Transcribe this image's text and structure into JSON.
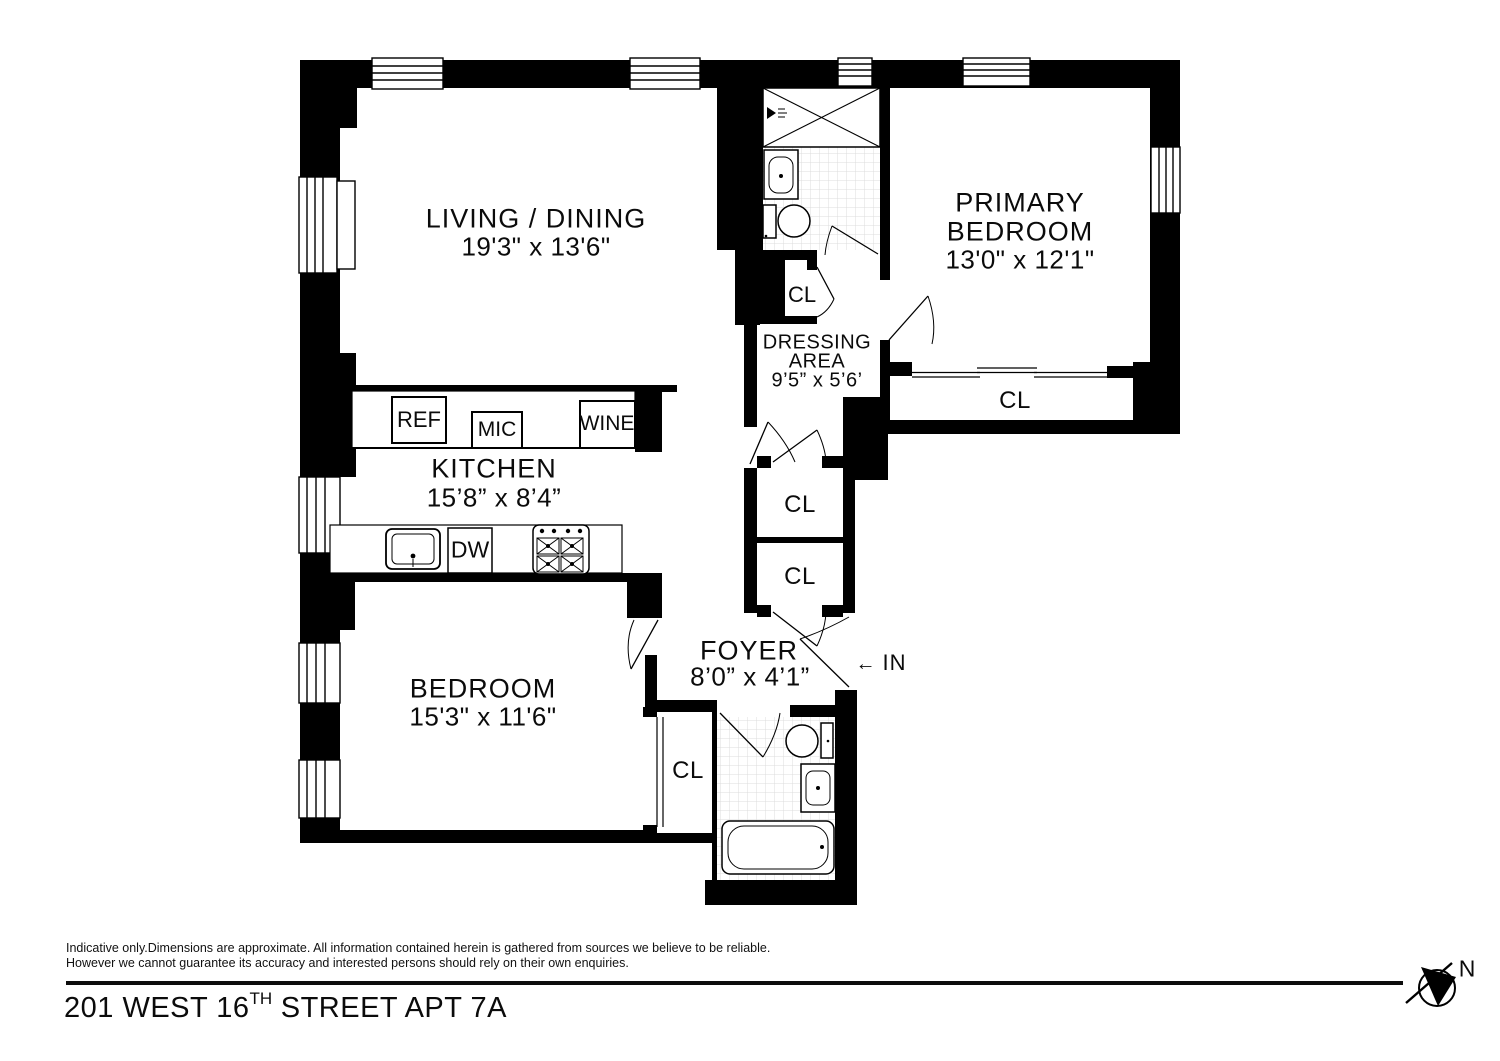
{
  "rooms": {
    "living": {
      "name": "LIVING / DINING",
      "dims": "19'3\" x 13'6\""
    },
    "primary": {
      "line1": "PRIMARY",
      "line2": "BEDROOM",
      "dims": "13'0\" x 12'1\""
    },
    "dressing": {
      "line1": "DRESSING",
      "line2": "AREA",
      "dims": "9’5” x 5’6’"
    },
    "kitchen": {
      "name": "KITCHEN",
      "dims": "15’8” x 8’4”"
    },
    "bedroom": {
      "name": "BEDROOM",
      "dims": "15'3\" x 11'6\""
    },
    "foyer": {
      "name": "FOYER",
      "dims": "8’0” x 4’1”"
    }
  },
  "closets": {
    "bath_hall": "CL",
    "primary": "CL",
    "hall_upper": "CL",
    "hall_lower": "CL",
    "bedroom": "CL"
  },
  "appliances": {
    "refrigerator": "REF",
    "microwave": "MIC",
    "wine_cooler": "WINE",
    "dishwasher": "DW"
  },
  "entrance": {
    "arrow": "←",
    "label": "IN"
  },
  "compass": {
    "label": "N"
  },
  "footer": {
    "disclaimer_line1": "Indicative only.Dimensions are approximate. All information contained herein is gathered from sources we believe to be reliable.",
    "disclaimer_line2": "However we cannot guarantee its accuracy and interested persons should rely on their own enquiries.",
    "title_main": "201 WEST 16",
    "title_sup": "TH",
    "title_rest": " STREET APT 7A"
  },
  "colors": {
    "ink": "#000000",
    "paper": "#ffffff",
    "tile_line": "#dcdcdc"
  }
}
